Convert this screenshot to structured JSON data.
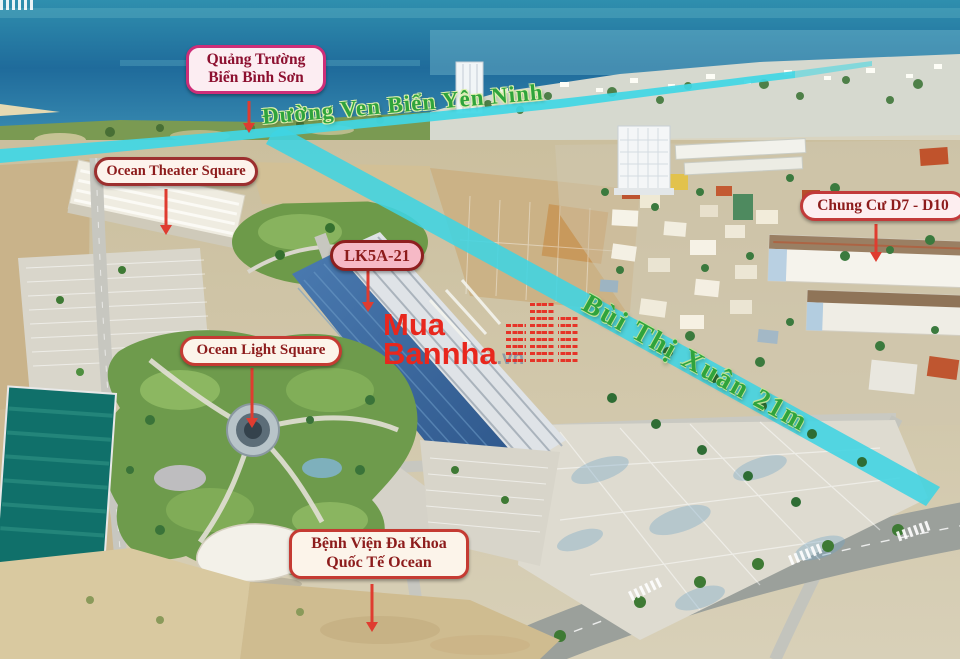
{
  "scene": {
    "description": "Aerial drone photo of a coastal real-estate development beside the sea, with highlighted roads and location callouts",
    "ocean_color": "#2577a3",
    "road_highlight_color": "#3fd5e3",
    "land_color": "#cdc2a2"
  },
  "roads": [
    {
      "name": "Đường Ven Biển Yên Ninh",
      "label_color": "#2fa43c"
    },
    {
      "name": "Bùi Thị Xuân 21m",
      "label_color": "#2fa43c"
    }
  ],
  "callouts": [
    {
      "id": "quang-truong-bien-binh-son",
      "lines": [
        "Quảng Trường",
        "Biển Bình Sơn"
      ],
      "border": "#ce2e78",
      "bg": "#fcedf2",
      "text_color": "#8d1030"
    },
    {
      "id": "ocean-theater-square",
      "lines": [
        "Ocean Theater Square"
      ],
      "border": "#9c2f2f",
      "bg": "#fdf3ec",
      "text_color": "#8d1c1c"
    },
    {
      "id": "lk5a-21",
      "lines": [
        "LK5A-21"
      ],
      "border": "#8e1f1f",
      "bg": "#f6b9c6",
      "text_color": "#8d1c1c"
    },
    {
      "id": "ocean-light-square",
      "lines": [
        "Ocean Light Square"
      ],
      "border": "#c53b33",
      "bg": "#fcf4ea",
      "text_color": "#8d1c1c"
    },
    {
      "id": "chung-cu-d7-d10",
      "lines": [
        "Chung Cư D7 - D10"
      ],
      "border": "#c23a3a",
      "bg": "#fdeef0",
      "text_color": "#8d1c1c"
    },
    {
      "id": "benh-vien-da-khoa-quoc-te-ocean",
      "lines": [
        "Bệnh Viện Đa Khoa",
        "Quốc Tế Ocean"
      ],
      "border": "#c53b33",
      "bg": "#fcf4ea",
      "text_color": "#8d1c1c"
    }
  ],
  "watermark": {
    "word1": "Mua",
    "word2": "Bannha",
    "suffix": ".vn",
    "color": "#e8271d",
    "suffix_color": "#8d9aa6"
  }
}
